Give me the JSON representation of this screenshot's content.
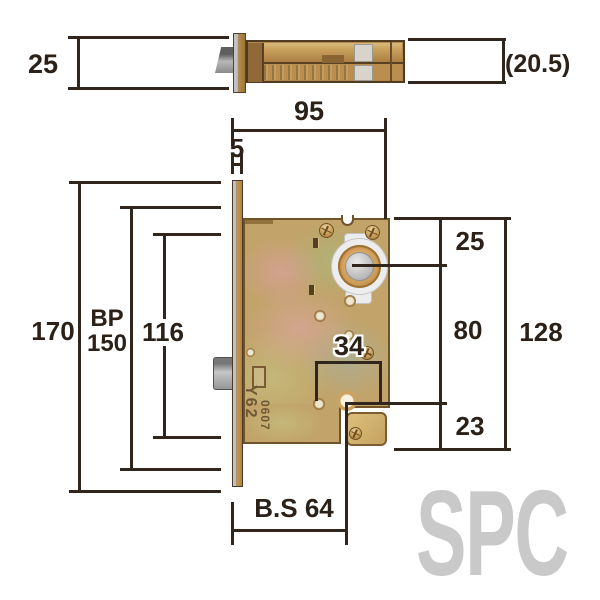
{
  "watermark": "SPC",
  "colors": {
    "line": "#31261d",
    "brass": "#c2a369",
    "watermark": "#c9c9c9"
  },
  "stamp": {
    "line1": "Y62",
    "line2": "0607"
  },
  "top_view": {
    "plate_height": "25",
    "body_thickness": "(20.5)"
  },
  "front_view": {
    "depth": "95",
    "plate_offset": "5",
    "total_height": "170",
    "bp_label": "BP",
    "bp_value": "150",
    "case_height": "116",
    "top_to_cylinder": "25",
    "cylinder_to_hub": "80",
    "right_span": "128",
    "hub_to_bottom": "23",
    "hole_spacing": "34",
    "backset": "B.S 64"
  }
}
